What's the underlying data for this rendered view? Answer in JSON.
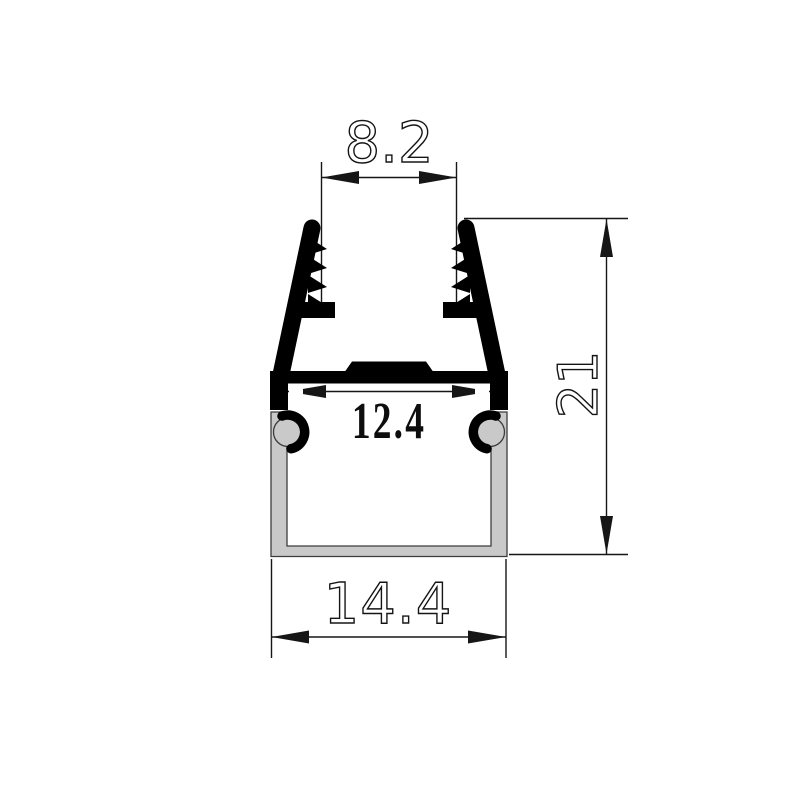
{
  "drawing": {
    "dimensions": {
      "top_opening_width": "8.2",
      "inner_width": "12.4",
      "overall_width": "14.4",
      "overall_height": "21"
    },
    "colors": {
      "clip_fill": "#000000",
      "channel_fill": "#c9c9c9",
      "channel_outline": "#3c3c3c",
      "dimension_lines": "#161616",
      "background": "#ffffff"
    }
  }
}
